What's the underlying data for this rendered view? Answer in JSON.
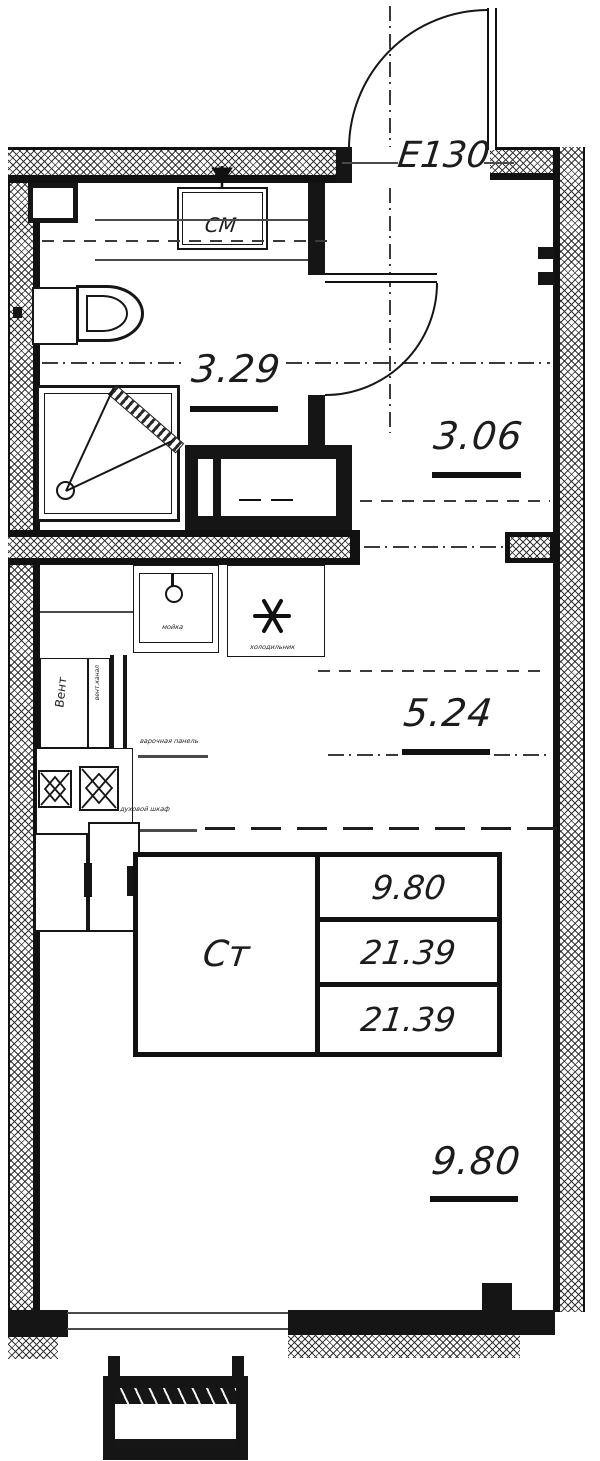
{
  "plan": {
    "entry_label": "E130",
    "rooms": {
      "bathroom": {
        "area": "3.29"
      },
      "hallway": {
        "area": "3.06"
      },
      "kitchen": {
        "area": "5.24"
      },
      "living": {
        "area": "9.80"
      }
    },
    "stamp": {
      "type_label": "Ст",
      "living_area": "9.80",
      "total_area": "21.39",
      "total_area_with_balcony": "21.39"
    },
    "annotations": {
      "washing_machine": "СМ",
      "vent": "Вент",
      "vent_channel": "вент.канал",
      "sink": "мойка",
      "fridge": "холодильник",
      "cooktop": "варочная панель",
      "oven": "духовой шкаф"
    },
    "colors": {
      "line": "#1c1c1c",
      "background": "#ffffff"
    }
  }
}
